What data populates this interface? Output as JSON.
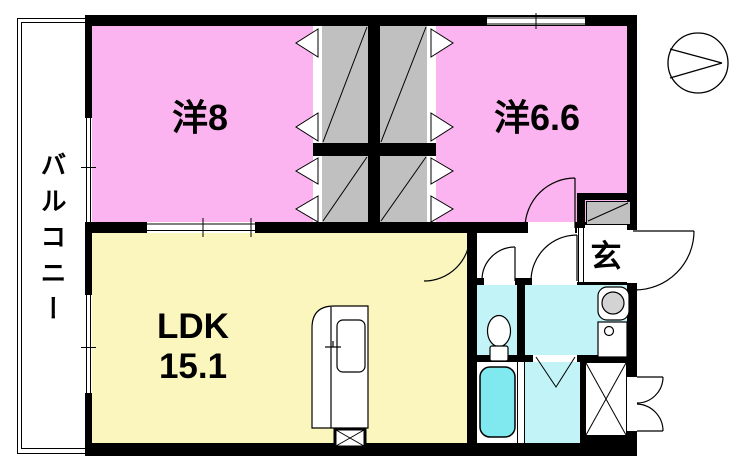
{
  "plan": {
    "balcony_label": "バルコニー",
    "room1_label": "洋8",
    "room2_label": "洋6.6",
    "ldk_label": "LDK",
    "ldk_size": "15.1",
    "entrance_label": "玄",
    "compass_label": "N"
  },
  "colors": {
    "wall": "#000000",
    "western_room": "#FBB4EF",
    "ldk": "#FAF6BE",
    "closet": "#C0C0C0",
    "wet_area": "#C2F3F7",
    "bathtub": "#7FE9EF",
    "washer_drum": "#D3D3D3"
  }
}
